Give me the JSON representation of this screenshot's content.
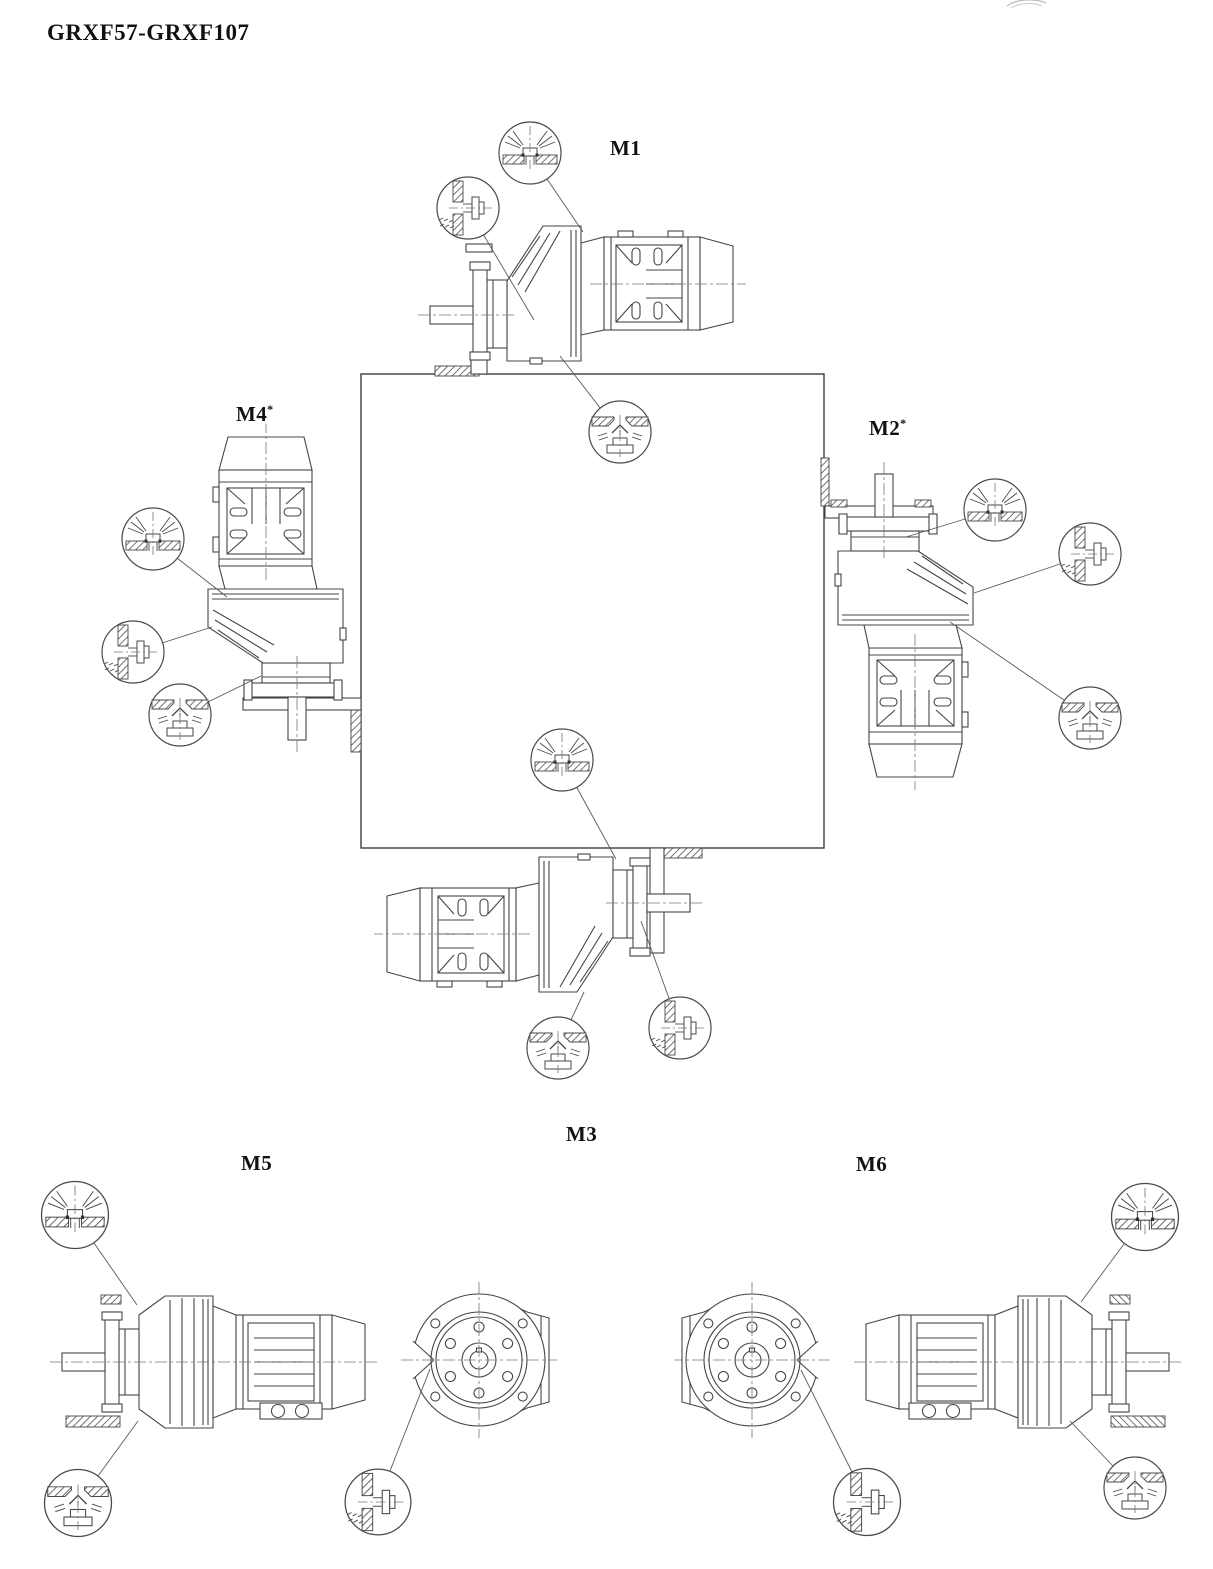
{
  "page": {
    "title": "GRXF57-GRXF107"
  },
  "colors": {
    "line": "#454545",
    "label": "#111111",
    "background": "#ffffff"
  },
  "positions": [
    {
      "id": "m1",
      "label": "M1",
      "superscript": ""
    },
    {
      "id": "m2",
      "label": "M2",
      "superscript": "*"
    },
    {
      "id": "m3",
      "label": "M3",
      "superscript": ""
    },
    {
      "id": "m4",
      "label": "M4",
      "superscript": "*"
    },
    {
      "id": "m5",
      "label": "M5",
      "superscript": ""
    },
    {
      "id": "m6",
      "label": "M6",
      "superscript": ""
    }
  ],
  "plug_symbols": {
    "breather": "breather-plug-icon",
    "oil_level": "oil-level-plug-icon",
    "oil_drain": "oil-drain-plug-icon"
  }
}
